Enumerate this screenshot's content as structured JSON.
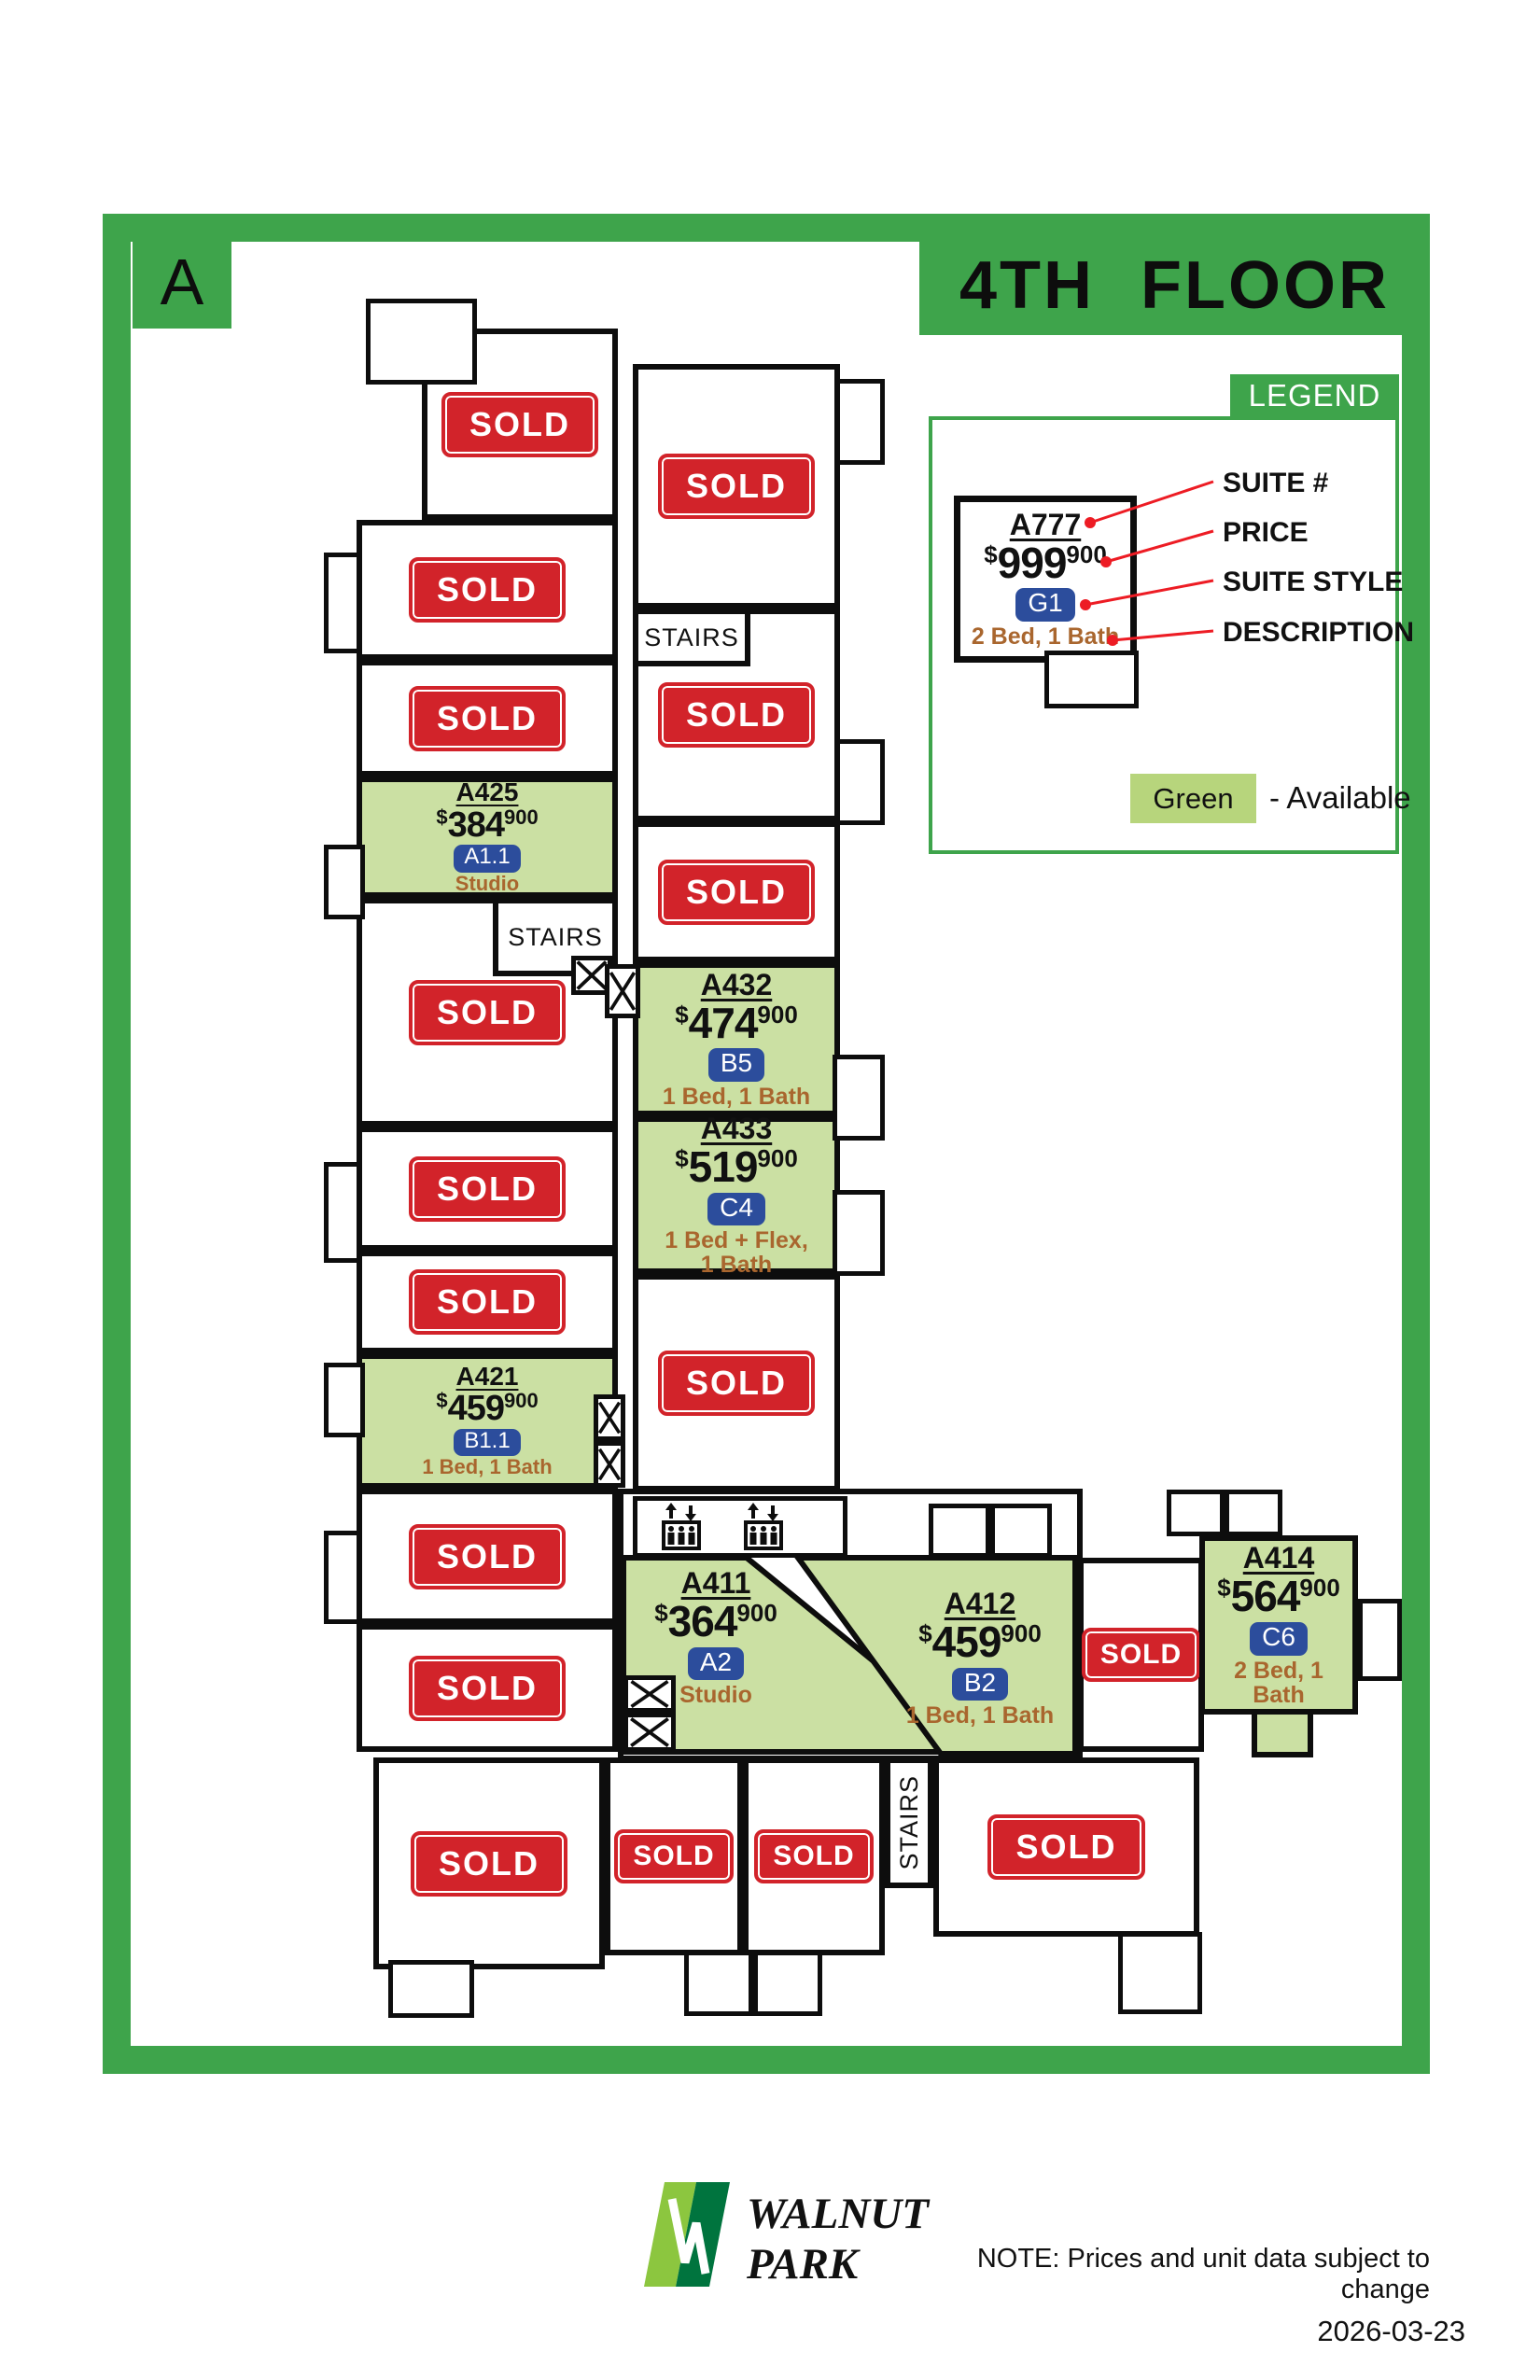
{
  "header": {
    "block_label": "A",
    "title": "4TH FLOOR"
  },
  "legend": {
    "title": "LEGEND",
    "sample": {
      "suite": "A777",
      "price_main": "999",
      "price_sup": "900",
      "style": "G1",
      "desc": "2 Bed, 1 Bath"
    },
    "callouts": [
      "SUITE #",
      "PRICE",
      "SUITE STYLE",
      "DESCRIPTION"
    ],
    "available_swatch_label": "Green",
    "available_text": "- Available"
  },
  "plan": {
    "currency": "$",
    "sold_label": "SOLD",
    "stairs_label": "STAIRS",
    "available_units": [
      {
        "id": "A425",
        "suite": "A425",
        "price_main": "384",
        "price_sup": "900",
        "style": "A1.1",
        "desc": [
          "Studio"
        ],
        "status": "available"
      },
      {
        "id": "A432",
        "suite": "A432",
        "price_main": "474",
        "price_sup": "900",
        "style": "B5",
        "desc": [
          "1 Bed, 1 Bath"
        ],
        "status": "available"
      },
      {
        "id": "A433",
        "suite": "A433",
        "price_main": "519",
        "price_sup": "900",
        "style": "C4",
        "desc": [
          "1 Bed + Flex,",
          "1 Bath"
        ],
        "status": "available"
      },
      {
        "id": "A421",
        "suite": "A421",
        "price_main": "459",
        "price_sup": "900",
        "style": "B1.1",
        "desc": [
          "1 Bed, 1 Bath"
        ],
        "status": "available"
      },
      {
        "id": "A411",
        "suite": "A411",
        "price_main": "364",
        "price_sup": "900",
        "style": "A2",
        "desc": [
          "Studio"
        ],
        "status": "available"
      },
      {
        "id": "A412",
        "suite": "A412",
        "price_main": "459",
        "price_sup": "900",
        "style": "B2",
        "desc": [
          "1 Bed, 1 Bath"
        ],
        "status": "available"
      },
      {
        "id": "A414",
        "suite": "A414",
        "price_main": "564",
        "price_sup": "900",
        "style": "C6",
        "desc": [
          "2 Bed, 1 Bath"
        ],
        "status": "available"
      }
    ]
  },
  "footer": {
    "brand_line1": "WALNUT",
    "brand_line2": "PARK",
    "note": "NOTE: Prices and unit data subject to change",
    "date": "2026-03-23"
  },
  "colors": {
    "frame_green": "#3EA44B",
    "available_green": "#CBE0A3",
    "swatch_green": "#B7D57C",
    "sold_red": "#D2232A",
    "style_blue": "#2C4D9C",
    "desc_brown": "#A9662E",
    "callout_red": "#ED1C24"
  }
}
